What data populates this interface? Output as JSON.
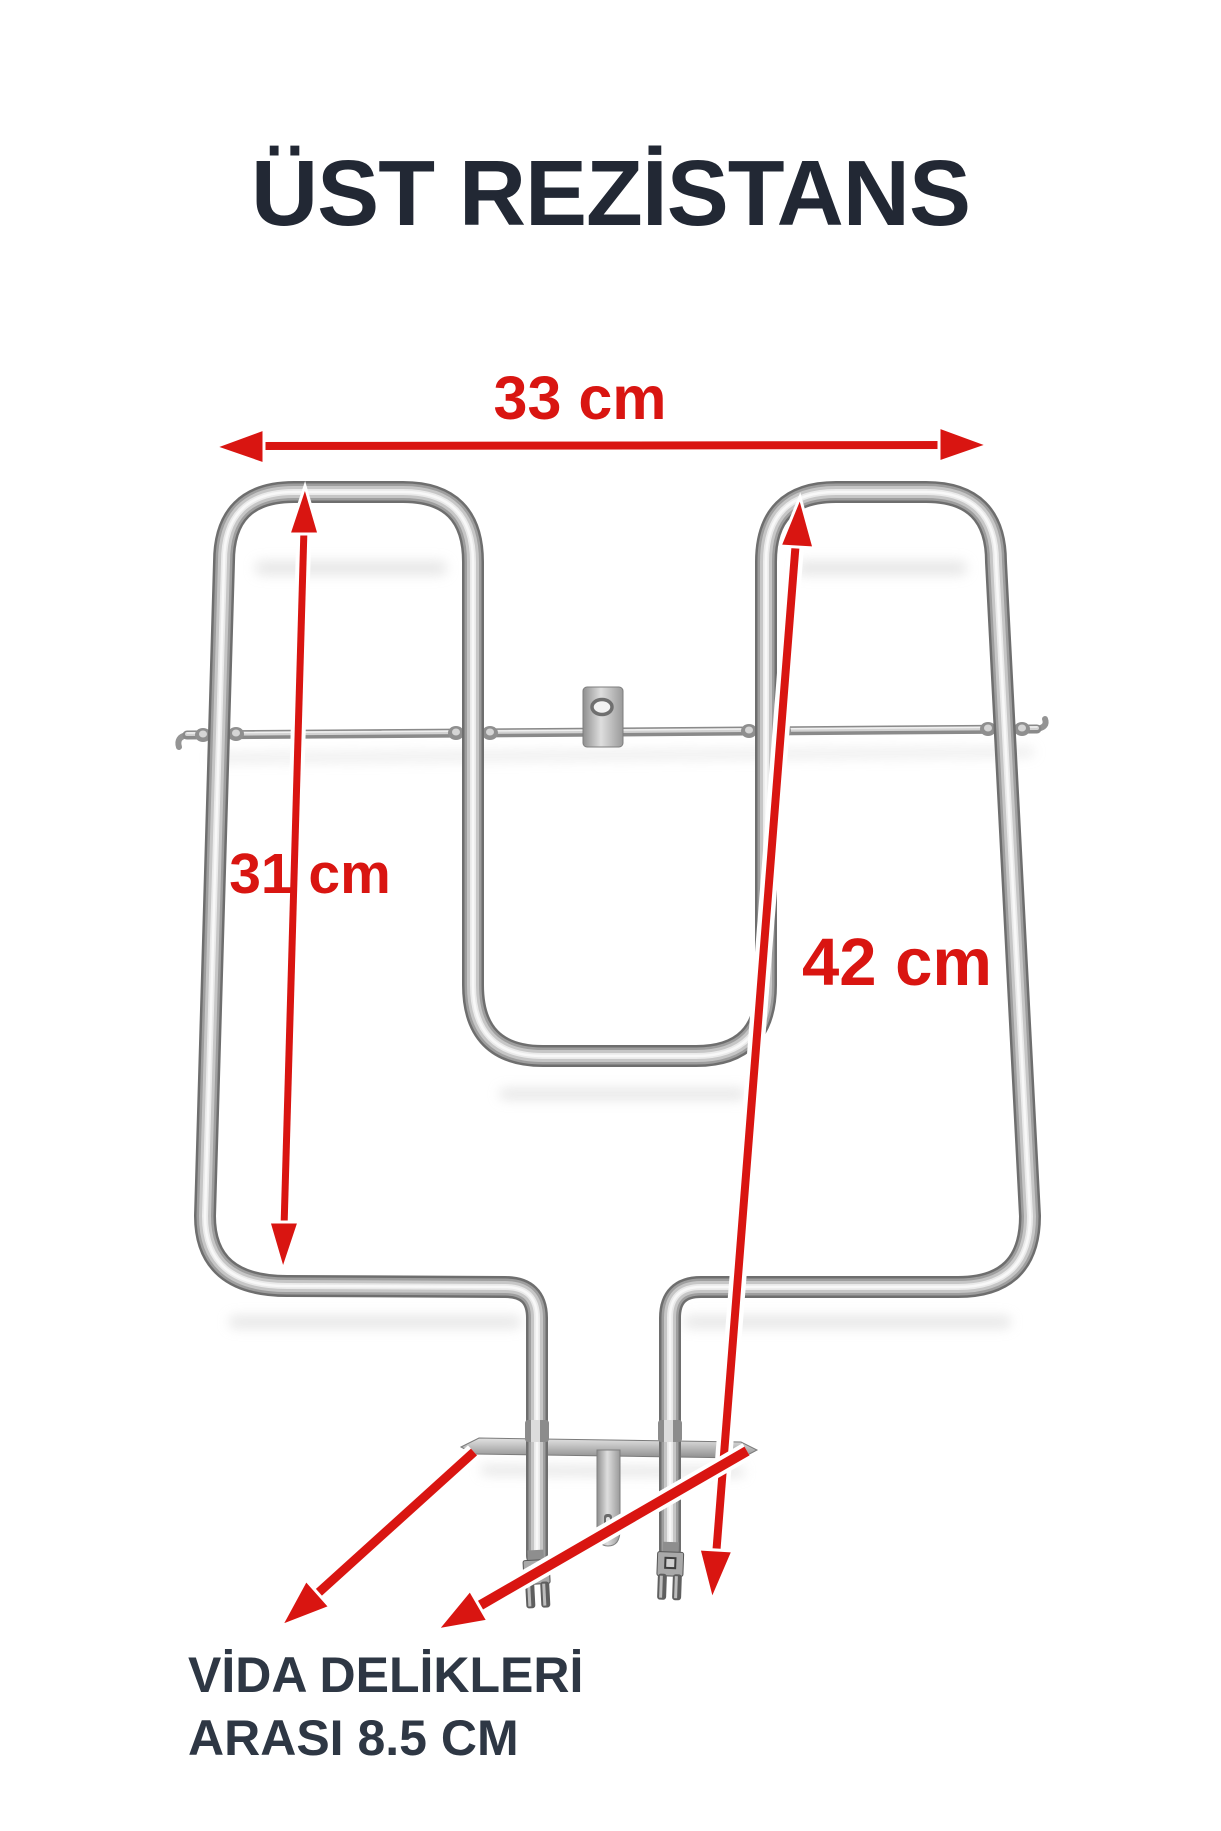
{
  "page": {
    "title": "ÜST REZİSTANS"
  },
  "annotations": {
    "width_label": "33 cm",
    "inner_height_label": "31 cm",
    "total_height_label": "42 cm",
    "screw_note_line1": "VİDA DELİKLERİ",
    "screw_note_line2": "ARASI 8.5 CM"
  },
  "colors": {
    "accent_red": "#d91511",
    "title_text": "#222834",
    "note_text": "#2e3744",
    "background": "#ffffff"
  },
  "icons": {
    "width_arrow": "double-headed-horizontal-arrow",
    "inner_height_arrow": "double-headed-vertical-arrow",
    "total_height_arrow": "double-headed-vertical-arrow",
    "screw_hole_arrow_left": "pointer-arrow-down-left",
    "screw_hole_arrow_right": "pointer-arrow-down-left"
  }
}
